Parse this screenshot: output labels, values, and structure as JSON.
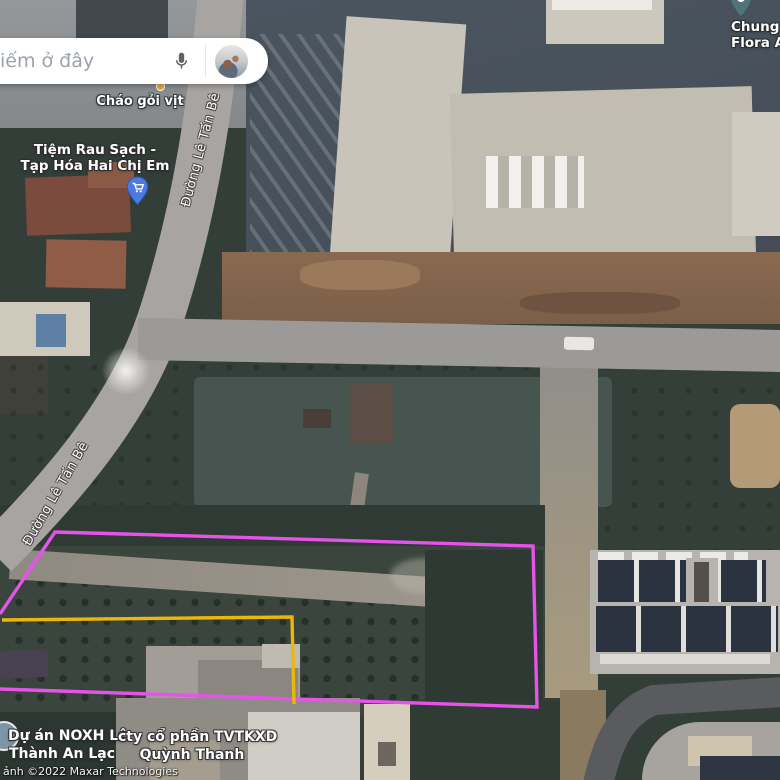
{
  "search_bar": {
    "visible_text": "iếm ở đây"
  },
  "pois": {
    "chao_goi_vit": {
      "name": "Cháo gỏi vịt"
    },
    "tiem_rau": {
      "line1": "Tiệm Rau Sạch -",
      "line2": "Tạp Hóa Hai Chị Em"
    },
    "chung_cu": {
      "line1": "Chung c",
      "line2": "Flora Aka"
    },
    "du_an": {
      "line1": "Dự án NOXH Lê",
      "line2": "Thành An Lạc"
    },
    "cty": {
      "line1": "cty cổ phần TVTKXD",
      "line2": "Quỳnh Thanh"
    }
  },
  "roads": {
    "le_tan_be_upper": "Đường Lê Tấn Bê",
    "le_tan_be_lower": "Đường Lê Tấn Bê"
  },
  "attribution": {
    "text": "ảnh ©2022 Maxar Technologies"
  },
  "overlay_colors": {
    "parcel": "#e653ea",
    "subparcel": "#edb70a"
  },
  "marker_colors": {
    "cart_pin": "#4b7ae2",
    "building_pin": "#53737c",
    "food_dot": "#eaa93d"
  }
}
